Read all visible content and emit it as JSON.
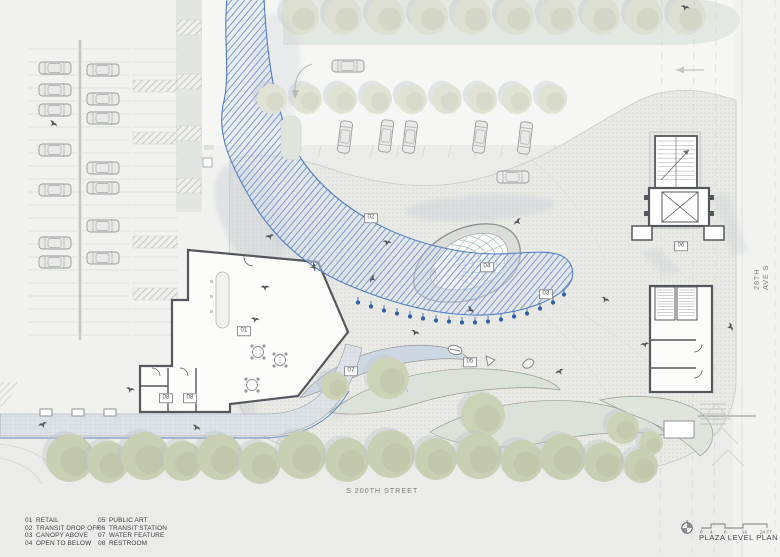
{
  "title_block": {
    "title": "PLAZA LEVEL PLAN"
  },
  "scale_bar": {
    "labels": [
      "0",
      "4",
      "8",
      "16",
      "24 FT"
    ]
  },
  "streets": {
    "bottom": "S 200TH STREET",
    "right": "28TH AVE S"
  },
  "legend": {
    "items": [
      {
        "num": "01",
        "label": "RETAIL"
      },
      {
        "num": "02",
        "label": "TRANSIT DROP OFF"
      },
      {
        "num": "03",
        "label": "CANOPY ABOVE"
      },
      {
        "num": "04",
        "label": "OPEN TO BELOW"
      },
      {
        "num": "05",
        "label": "PUBLIC ART"
      },
      {
        "num": "06",
        "label": "TRANSIT STATION"
      },
      {
        "num": "07",
        "label": "WATER FEATURE"
      },
      {
        "num": "08",
        "label": "RESTROOM"
      }
    ]
  },
  "markers": [
    {
      "num": "01",
      "x": 244,
      "y": 331
    },
    {
      "num": "02",
      "x": 371,
      "y": 218
    },
    {
      "num": "03",
      "x": 546,
      "y": 294
    },
    {
      "num": "04",
      "x": 487,
      "y": 267
    },
    {
      "num": "05",
      "x": 470,
      "y": 362
    },
    {
      "num": "06",
      "x": 681,
      "y": 246
    },
    {
      "num": "07",
      "x": 351,
      "y": 371
    },
    {
      "num": "08",
      "x": 166,
      "y": 398
    },
    {
      "num": "08",
      "x": 190,
      "y": 398
    }
  ],
  "colors": {
    "canopy_line": "#4f7ec6",
    "canopy_hatch": "#7d9bd0",
    "canopy_fill": "#dce4f2",
    "column_dot": "#2d5fae",
    "wall": "#54575b",
    "tree_top": "#dcdfd1",
    "tree_mid": "#e0e2d4",
    "tree_bottom": "#c9cfb2",
    "tree_lens": "#ccd2b6",
    "tree_shadow": "#b9c0c9",
    "lens_green": "#dce2d9",
    "water": "#cdd7e3",
    "teal": "#9fbdb4",
    "paving_base": "#e9eae6",
    "paving_dot": "#d4d6d2"
  },
  "plan_elements": {
    "cars": [
      {
        "x": 55,
        "y": 68
      },
      {
        "x": 55,
        "y": 90
      },
      {
        "x": 55,
        "y": 110
      },
      {
        "x": 55,
        "y": 150
      },
      {
        "x": 55,
        "y": 190
      },
      {
        "x": 55,
        "y": 243
      },
      {
        "x": 55,
        "y": 262
      },
      {
        "x": 103,
        "y": 70
      },
      {
        "x": 103,
        "y": 99
      },
      {
        "x": 103,
        "y": 118
      },
      {
        "x": 103,
        "y": 168
      },
      {
        "x": 103,
        "y": 188
      },
      {
        "x": 103,
        "y": 226
      },
      {
        "x": 103,
        "y": 258
      },
      {
        "x": 348,
        "y": 66
      },
      {
        "x": 513,
        "y": 177
      },
      {
        "x": 345,
        "y": 137,
        "rot": 97
      },
      {
        "x": 386,
        "y": 136,
        "rot": 97
      },
      {
        "x": 410,
        "y": 137,
        "rot": 97
      },
      {
        "x": 480,
        "y": 137,
        "rot": 97
      },
      {
        "x": 525,
        "y": 138,
        "rot": 97
      }
    ],
    "trees_top": [
      300,
      343,
      386,
      429,
      472,
      515,
      558,
      601,
      644,
      687
    ],
    "trees_mid": [
      272,
      307,
      342,
      377,
      412,
      447,
      482,
      517,
      552
    ],
    "trees_bottom": [
      {
        "x": 70,
        "y": 458,
        "r": 24
      },
      {
        "x": 108,
        "y": 462,
        "r": 21
      },
      {
        "x": 145,
        "y": 456,
        "r": 24
      },
      {
        "x": 183,
        "y": 461,
        "r": 20
      },
      {
        "x": 220,
        "y": 457,
        "r": 23
      },
      {
        "x": 260,
        "y": 463,
        "r": 21
      },
      {
        "x": 302,
        "y": 455,
        "r": 24
      },
      {
        "x": 347,
        "y": 460,
        "r": 22
      },
      {
        "x": 391,
        "y": 454,
        "r": 24
      },
      {
        "x": 436,
        "y": 459,
        "r": 21
      },
      {
        "x": 479,
        "y": 456,
        "r": 23
      },
      {
        "x": 522,
        "y": 461,
        "r": 21
      },
      {
        "x": 563,
        "y": 457,
        "r": 23
      },
      {
        "x": 604,
        "y": 462,
        "r": 20
      },
      {
        "x": 641,
        "y": 466,
        "r": 17
      }
    ],
    "trees_lens": [
      {
        "x": 388,
        "y": 378,
        "r": 21
      },
      {
        "x": 483,
        "y": 415,
        "r": 22
      },
      {
        "x": 335,
        "y": 386,
        "r": 14
      },
      {
        "x": 623,
        "y": 428,
        "r": 16
      },
      {
        "x": 651,
        "y": 443,
        "r": 12
      }
    ],
    "birds": [
      {
        "x": 53,
        "y": 124,
        "r": 40
      },
      {
        "x": 270,
        "y": 237,
        "r": -15
      },
      {
        "x": 313,
        "y": 267,
        "r": 80
      },
      {
        "x": 387,
        "y": 243,
        "r": 10
      },
      {
        "x": 373,
        "y": 279,
        "r": -60
      },
      {
        "x": 415,
        "y": 333,
        "r": 25
      },
      {
        "x": 560,
        "y": 372,
        "r": -30
      },
      {
        "x": 685,
        "y": 8,
        "r": 15
      },
      {
        "x": 730,
        "y": 327,
        "r": 70
      },
      {
        "x": 43,
        "y": 425,
        "r": -20
      },
      {
        "x": 130,
        "y": 390,
        "r": 15
      },
      {
        "x": 518,
        "y": 222,
        "r": -45
      },
      {
        "x": 605,
        "y": 300,
        "r": 30
      },
      {
        "x": 645,
        "y": 345,
        "r": -10
      },
      {
        "x": 470,
        "y": 310,
        "r": 55
      },
      {
        "x": 255,
        "y": 320,
        "r": 10
      },
      {
        "x": 196,
        "y": 428,
        "r": 35
      },
      {
        "x": 265,
        "y": 288,
        "r": 0
      }
    ],
    "canopy_columns": [
      [
        358,
        301
      ],
      [
        371,
        305
      ],
      [
        384,
        309
      ],
      [
        397,
        312
      ],
      [
        410,
        315
      ],
      [
        423,
        317
      ],
      [
        436,
        319
      ],
      [
        449,
        320
      ],
      [
        462,
        321
      ],
      [
        475,
        321
      ],
      [
        488,
        320
      ],
      [
        501,
        318
      ],
      [
        514,
        315
      ],
      [
        527,
        312
      ],
      [
        540,
        307
      ],
      [
        553,
        301
      ],
      [
        564,
        293
      ]
    ],
    "benches": [
      {
        "x": 40,
        "y": 409,
        "w": 12,
        "h": 7
      },
      {
        "x": 72,
        "y": 409,
        "w": 12,
        "h": 7
      },
      {
        "x": 104,
        "y": 409,
        "w": 12,
        "h": 7
      },
      {
        "x": 664,
        "y": 421,
        "w": 30,
        "h": 17
      }
    ],
    "station_squares": [
      {
        "x": 632,
        "y": 226,
        "w": 20,
        "h": 14
      },
      {
        "x": 704,
        "y": 226,
        "w": 20,
        "h": 14
      }
    ],
    "tables": [
      {
        "x": 258,
        "y": 352
      },
      {
        "x": 280,
        "y": 360
      },
      {
        "x": 252,
        "y": 385
      }
    ],
    "hatched_stalls": [
      {
        "x": 133,
        "y": 80,
        "w": 44,
        "h": 12
      },
      {
        "x": 133,
        "y": 132,
        "w": 44,
        "h": 12
      },
      {
        "x": 133,
        "y": 236,
        "w": 44,
        "h": 12
      },
      {
        "x": 133,
        "y": 288,
        "w": 44,
        "h": 12
      },
      {
        "x": 177,
        "y": 20,
        "w": 24,
        "h": 15
      },
      {
        "x": 177,
        "y": 74,
        "w": 24,
        "h": 15
      },
      {
        "x": 177,
        "y": 126,
        "w": 24,
        "h": 15
      },
      {
        "x": 177,
        "y": 178,
        "w": 24,
        "h": 15
      }
    ],
    "wall_squares": [
      {
        "x": 203,
        "y": 38
      },
      {
        "x": 203,
        "y": 108
      },
      {
        "x": 203,
        "y": 158
      }
    ]
  }
}
